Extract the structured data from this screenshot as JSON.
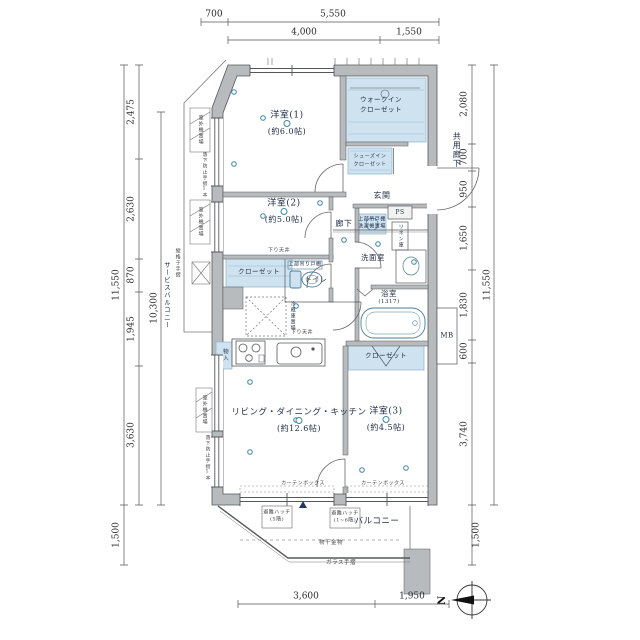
{
  "colors": {
    "wall": "#b7bbbd",
    "closet_fill": "#cfe2ef",
    "accent": "#3d85a8",
    "text": "#1c2b45"
  },
  "rooms": {
    "bedroom1": {
      "name": "洋室(1)",
      "size": "(約6.0帖)"
    },
    "bedroom2": {
      "name": "洋室(2)",
      "size": "(約5.0帖)"
    },
    "bedroom3": {
      "name": "洋室(3)",
      "size": "(約4.5帖)"
    },
    "ldk": {
      "name": "リビング・ダイニング・キッチン",
      "size": "(約12.6帖)"
    },
    "wic": {
      "line1": "ウォークイン",
      "line2": "クローゼット"
    },
    "sic": {
      "line1": "シューズイン",
      "line2": "クローゼット"
    },
    "entrance": "玄関",
    "hallway": "廊下",
    "washroom": "洗面室",
    "bathroom": {
      "name": "浴室",
      "size": "(1317)"
    },
    "toilet": "トイレ",
    "toilet_cabinet": "上部吊り戸棚",
    "closet2": "クローゼット",
    "closet3": "クローゼット",
    "storage": "物入",
    "linen": "リネン庫",
    "fridge": "冷蔵庫置場",
    "washer": {
      "line1": "上部吊戸棚",
      "line2": "洗濯機置場"
    },
    "ps": "PS",
    "mb": "MB",
    "balcony": "バルコニー",
    "service_balcony": "サービスバルコニー",
    "common_corridor": "共用廊下"
  },
  "annotations": {
    "laundry_hw": "物干金物",
    "glass_rail": "ガラス手摺",
    "lattice_rail": "縦格子手摺",
    "curtain_box": "カーテンボックス",
    "hatch1": {
      "line1": "避難ハッチ",
      "line2": "(5階)"
    },
    "hatch2": {
      "line1": "避難ハッチ",
      "line2": "(1~6階)"
    },
    "outdoor_unit": "室外機置場",
    "fall_rail": "落下防止手摺1本",
    "lowered_ceiling": "下り天井",
    "compass_n": "N"
  },
  "dims": {
    "top": [
      "700",
      "5,550",
      "4,000",
      "1,550"
    ],
    "bottom": [
      "3,600",
      "1,950"
    ],
    "left": [
      "2,475",
      "2,630",
      "870",
      "1,945",
      "3,630",
      "11,550",
      "10,300",
      "1,500"
    ],
    "right": [
      "2,080",
      "700",
      "950",
      "1,650",
      "1,830",
      "600",
      "3,740",
      "11,550",
      "1,500"
    ]
  }
}
